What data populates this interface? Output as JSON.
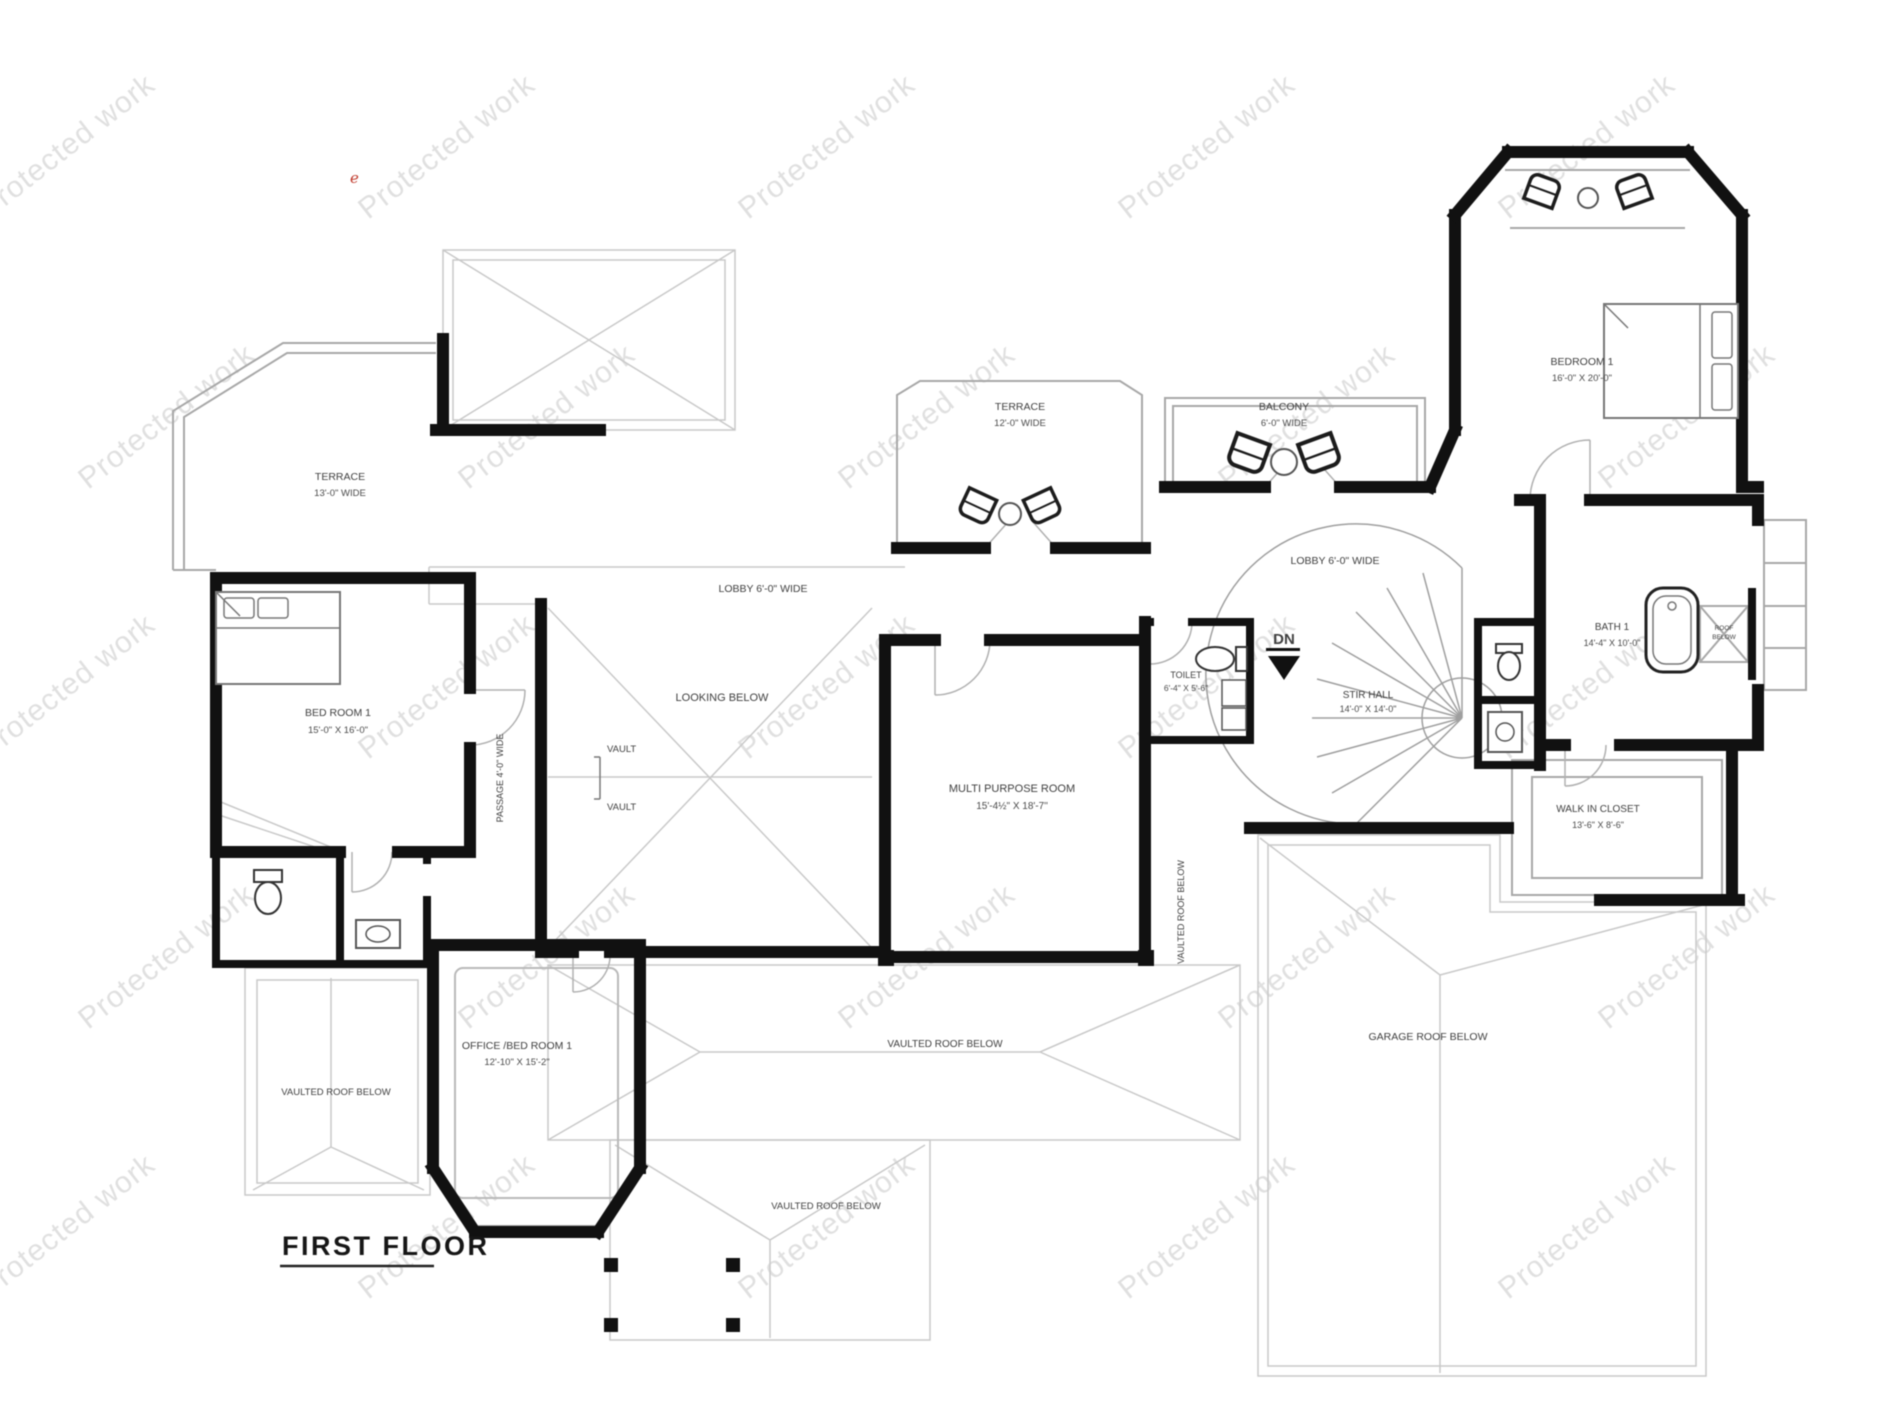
{
  "title": "FIRST FLOOR",
  "stray_mark": "e",
  "watermark": {
    "text": "Protected work"
  },
  "colors": {
    "wall": "#111111",
    "roof_line": "#c9c9c9",
    "outline": "#a8a8a8",
    "label": "#3f3f3f",
    "watermark": "#cbcbcb",
    "accent_red": "#c0392b"
  },
  "rooms": {
    "terrace_left": {
      "name": "TERRACE",
      "dim": "13'-0\" WIDE"
    },
    "bedroom_left": {
      "name": "BED ROOM 1",
      "dim": "15'-0\" X 16'-0\""
    },
    "lobby_left": {
      "name": "LOBBY 6'-0\" WIDE"
    },
    "looking_below": {
      "name": "LOOKING BELOW"
    },
    "vault": {
      "name": "VAULT"
    },
    "passage": {
      "name": "PASSAGE 4'-0\" WIDE"
    },
    "terrace_center": {
      "name": "TERRACE",
      "dim": "12'-0\" WIDE"
    },
    "balcony": {
      "name": "BALCONY",
      "dim": "6'-0\" WIDE"
    },
    "lobby_right": {
      "name": "LOBBY 6'-0\" WIDE"
    },
    "multi_purpose": {
      "name": "MULTI PURPOSE ROOM",
      "dim": "15'-4½\" X 18'-7\""
    },
    "toilet": {
      "name": "TOILET",
      "dim": "6'-4\" X 5'-6\""
    },
    "dn": {
      "label": "DN"
    },
    "stair_hall": {
      "name": "STIR HALL",
      "dim": "14'-0\" X 14'-0\""
    },
    "bedroom_right": {
      "name": "BEDROOM 1",
      "dim": "16'-0\" X 20'-0\""
    },
    "bath": {
      "name": "BATH 1",
      "dim": "14'-4\" X 10'-0\""
    },
    "roof_niche": {
      "line1": "ROOF",
      "line2": "BELOW"
    },
    "walk_in_closet": {
      "name": "WALK IN CLOSET",
      "dim": "13'-6\" X 8'-6\""
    },
    "office_bedroom": {
      "name": "OFFICE /BED ROOM 1",
      "dim": "12'-10\" X 15'-2\""
    },
    "vaulted_roof_left": {
      "name": "VAULTED ROOF BELOW"
    },
    "vaulted_roof_center": {
      "name": "VAULTED ROOF BELOW"
    },
    "vaulted_roof_bottom": {
      "name": "VAULTED ROOF BELOW"
    },
    "vaulted_roof_vertical": {
      "name": "VAULTED ROOF BELOW"
    },
    "garage_roof": {
      "name": "GARAGE ROOF BELOW"
    }
  }
}
